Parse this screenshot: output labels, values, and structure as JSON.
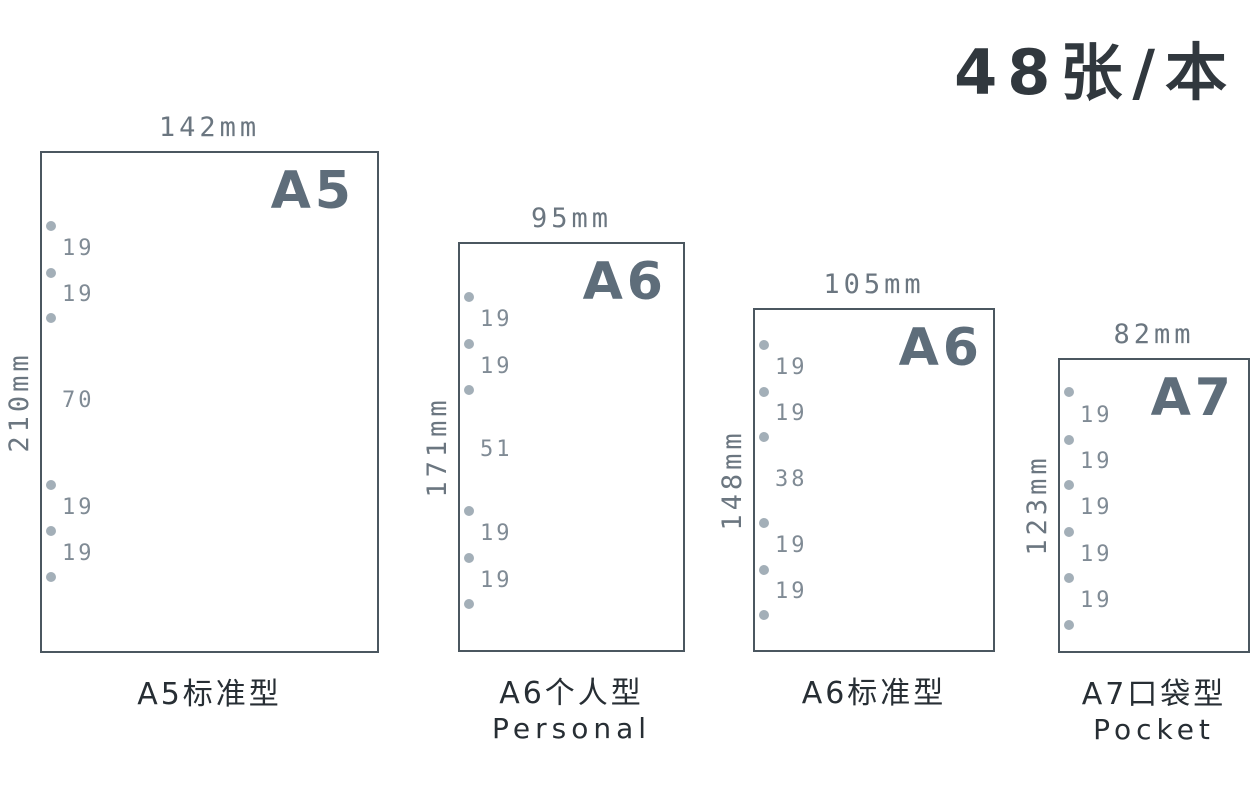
{
  "title": "48张/本",
  "unit": "mm",
  "colors": {
    "background": "#ffffff",
    "sheet_border": "#4b5760",
    "size_label": "#5e6d7a",
    "dimension_text": "#6b7680",
    "gap_text": "#808b95",
    "hole": "#a3afb8",
    "caption": "#272e34",
    "title": "#31383e"
  },
  "sheets": [
    {
      "size_label": "A5",
      "width_label": "142mm",
      "height_label": "210mm",
      "caption": "A5标准型",
      "caption_en": "",
      "hole_count": 6,
      "gaps": [
        "19",
        "19",
        "70",
        "19",
        "19"
      ]
    },
    {
      "size_label": "A6",
      "width_label": "95mm",
      "height_label": "171mm",
      "caption": "A6个人型",
      "caption_en": "Personal",
      "hole_count": 6,
      "gaps": [
        "19",
        "19",
        "51",
        "19",
        "19"
      ]
    },
    {
      "size_label": "A6",
      "width_label": "105mm",
      "height_label": "148mm",
      "caption": "A6标准型",
      "caption_en": "",
      "hole_count": 6,
      "gaps": [
        "19",
        "19",
        "38",
        "19",
        "19"
      ]
    },
    {
      "size_label": "A7",
      "width_label": "82mm",
      "height_label": "123mm",
      "caption": "A7口袋型",
      "caption_en": "Pocket",
      "hole_count": 6,
      "gaps": [
        "19",
        "19",
        "19",
        "19",
        "19"
      ]
    }
  ]
}
